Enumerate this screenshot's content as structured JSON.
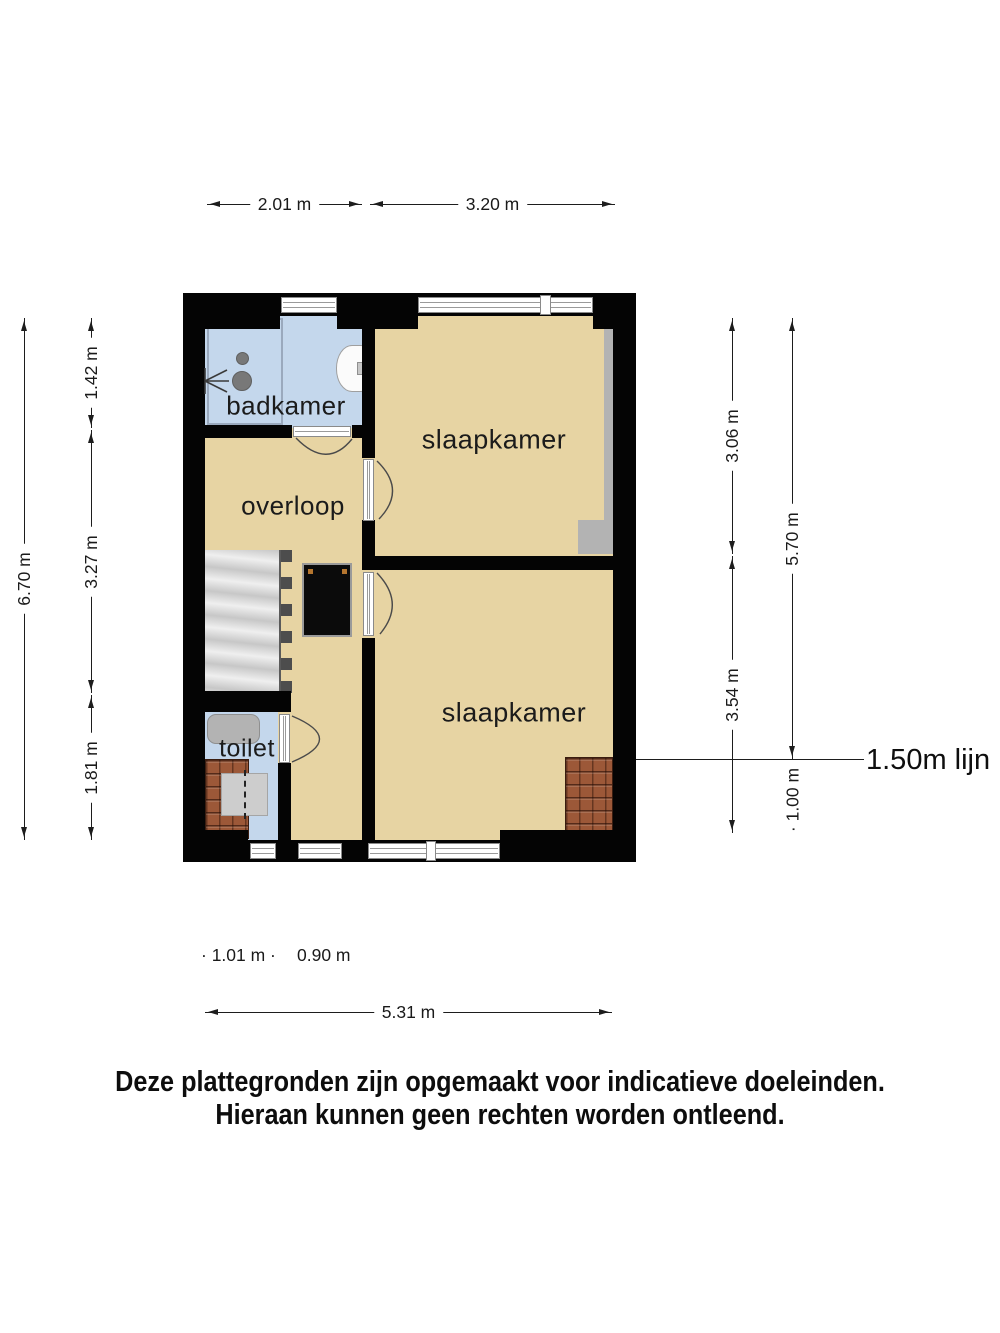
{
  "rooms": {
    "badkamer": "badkamer",
    "overloop": "overloop",
    "toilet": "toilet",
    "slaapkamer_top": "slaapkamer",
    "slaapkamer_bottom": "slaapkamer"
  },
  "dimensions": {
    "top_left": "2.01 m",
    "top_right": "3.20 m",
    "bottom": "5.31 m",
    "left_outer": "6.70 m",
    "left_inner": [
      "1.42 m",
      "3.27 m",
      "1.81 m"
    ],
    "right_inner": [
      "3.06 m",
      "3.54 m"
    ],
    "right_outer_upper": "5.70 m",
    "right_outer_lower": "· 1.00 m",
    "bottom_small_left": "· 1.01 m ·",
    "bottom_small_right": "0.90 m",
    "line_150_label": "1.50m lijn"
  },
  "disclaimer": {
    "line1": "Deze plattegronden zijn opgemaakt voor indicatieve doeleinden.",
    "line2": "Hieraan kunnen geen rechten worden ontleend."
  },
  "colors": {
    "wall": "#040404",
    "floor_tan": "#e7d4a3",
    "floor_blue": "#c4d7ec",
    "roof_tile": "#9c5838",
    "fixture_gray": "#b3b3b3",
    "dimension": "#1d1d1d"
  }
}
